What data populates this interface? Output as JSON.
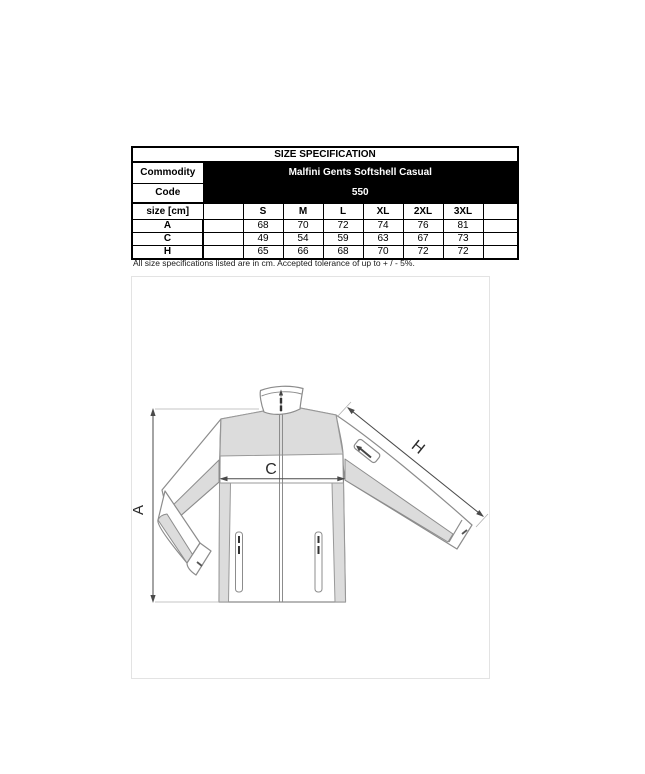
{
  "spec_table": {
    "title": "SIZE SPECIFICATION",
    "commodity_label": "Commodity",
    "commodity_value": "Malfini Gents Softshell Casual",
    "code_label": "Code",
    "code_value": "550",
    "size_header_label": "size [cm]",
    "sizes": [
      "S",
      "M",
      "L",
      "XL",
      "2XL",
      "3XL"
    ],
    "rows": [
      {
        "label": "A",
        "values": [
          "68",
          "70",
          "72",
          "74",
          "76",
          "81"
        ]
      },
      {
        "label": "C",
        "values": [
          "49",
          "54",
          "59",
          "63",
          "67",
          "73"
        ]
      },
      {
        "label": "H",
        "values": [
          "65",
          "66",
          "68",
          "70",
          "72",
          "72"
        ]
      }
    ],
    "note": "All size specifications listed are in cm. Accepted tolerance of up to + / - 5%.",
    "colors": {
      "header_bg": "#000000",
      "header_text": "#ffffff",
      "border": "#000000"
    }
  },
  "diagram": {
    "product": "softshell-jacket-technical-drawing",
    "labels": {
      "A": "A",
      "C": "C",
      "H": "H"
    },
    "colors": {
      "panel_fill": "#dcdcdc",
      "outline": "#8c8c8c",
      "measure": "#4a4a4a"
    }
  }
}
